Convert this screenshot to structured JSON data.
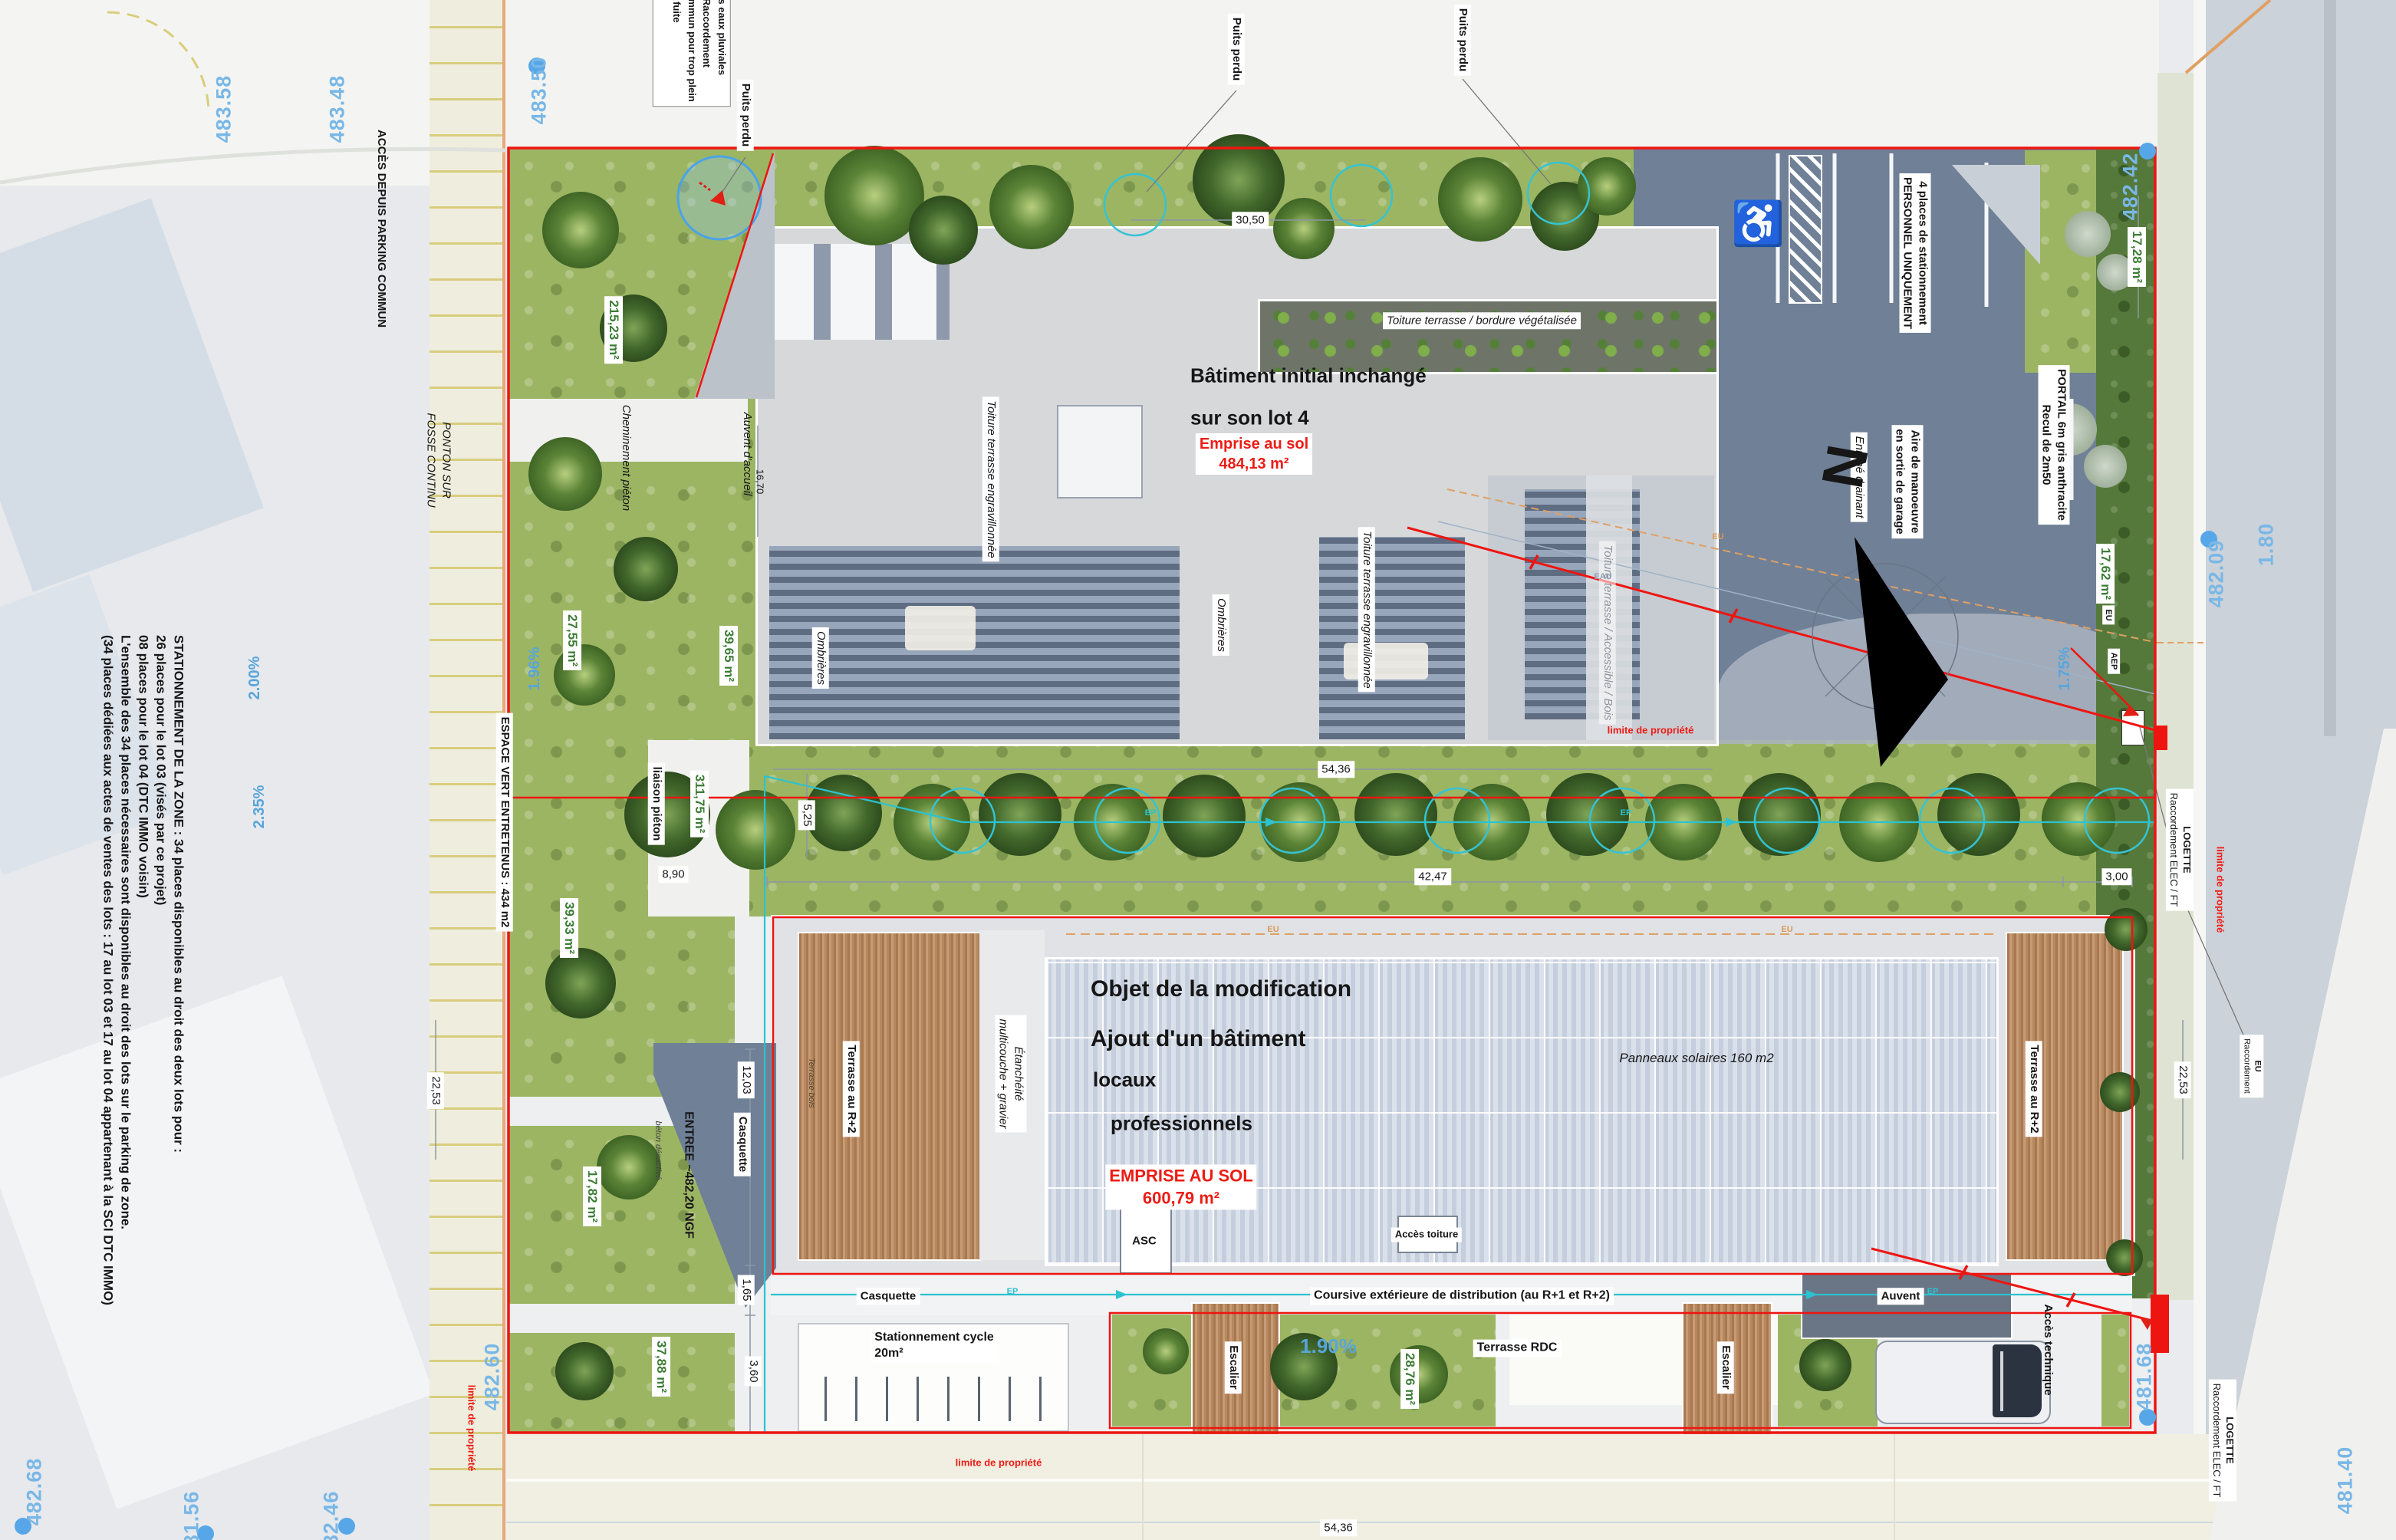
{
  "plan": {
    "notes": {
      "storm_lines": [
        "des eaux pluviales",
        "e. Raccordement",
        "commun pour trop plein",
        "de fuite",
        "re"
      ],
      "parking_lines": [
        "STATIONNEMENT DE LA ZONE : 34 places disponibles au droit des deux lots pour :",
        "26 places pour le lot 03 (visés par ce projet)",
        "08 places pour le lot 04 (DTC IMMO voisin)",
        "L'ensemble des 34 places nécessaires sont disponibles au droit des lots sur le parking de zone.",
        "(34 places dédiées aux actes de ventes des lots : 17 au lot 03 et 17 au lot 04 appartenant à la SCI DTC IMMO)"
      ]
    },
    "roads": {
      "acces_parking": "ACCÈS DEPUIS PARKING COMMUN",
      "ponton_l1": "PONTON SUR",
      "ponton_l2": "FOSSE CONTINU",
      "espace_vert": "ESPACE VERT ENTRETENUS : 434 m2",
      "liaison_pieton": "liaison piéton",
      "cheminement_pieton": "Cheminement piéton"
    },
    "b1": {
      "title_l1": "Bâtiment initial inchangé",
      "title_l2": "sur son lot 4",
      "emprise_l1": "Emprise au sol",
      "emprise_l2": "484,13 m²",
      "toiture_bordure": "Toiture terrasse / bordure végétalisée",
      "toiture_engrav": "Toiture terrasse engravillonnée",
      "toiture_access": "Toiture terrasse / Accessible / Bois",
      "ombrieres": "Ombrières",
      "auvent_accueil": "Auvent d'accueil"
    },
    "b2": {
      "title_l1": "Objet de la modification",
      "title_l2": "Ajout d'un bâtiment",
      "sub_l1": "locaux",
      "sub_l2": "professionnels",
      "emprise_l1": "EMPRISE AU SOL",
      "emprise_l2": "600,79 m²",
      "panneaux": "Panneaux solaires 160 m2",
      "terrasse_r2": "Terrasse au R+2",
      "terrasse_bois": "Terrasse bois",
      "etancheite_l1": "Étanchéité",
      "etancheite_l2": "multicouche + gravier",
      "asc": "ASC",
      "acces_toiture": "Accès toiture",
      "casquette": "Casquette",
      "entree": "ENTREE ~482,20 NGF",
      "beton": "béton désactivé",
      "coursive": "Coursive extérieure de distribution (au R+1 et R+2)",
      "cycle_l1": "Stationnement cycle",
      "cycle_l2": "20m²",
      "escalier": "Escalier",
      "terrasse_rdc": "Terrasse RDC",
      "auvent": "Auvent",
      "acces_technique": "Accès technique"
    },
    "parking": {
      "puits_perdu": "Puits perdu",
      "places_l1": "4 places de stationnement",
      "places_l2": "PERSONNEL UNIQUEMENT",
      "portail_l1": "PORTAIL 6m gris anthracite",
      "portail_l2": "Recul de 2m50",
      "aire_l1": "Aire de manoeuvre",
      "aire_l2": "en sortie de garage",
      "enrobe": "Enrobé drainant",
      "north": "N",
      "handicap_icon": "♿"
    },
    "limits": {
      "limite": "limite de propriété"
    },
    "util": {
      "logette_l1": "LOGETTE",
      "logette_l2": "Raccordement ELEC / FT",
      "eu_racc_l1": "EU",
      "eu_racc_l2": "Raccordement",
      "eu": "EU",
      "aep": "AEP",
      "ep": "EP",
      "eau": "EAU"
    },
    "areas": {
      "a215_23": "215,23 m²",
      "a39_65": "39,65 m²",
      "a27_55": "27,55 m²",
      "a311_75": "311,75 m²",
      "a39_33": "39,33 m²",
      "a17_82": "17,82 m²",
      "a37_88": "37,88 m²",
      "a28_76": "28,76 m²",
      "a17_62": "17,62 m²",
      "a17_28": "17,28 m²"
    },
    "dims": {
      "d30_50": "30,50",
      "d54_36": "54,36",
      "d42_47": "42,47",
      "d3_00": "3,00",
      "d8_90": "8,90",
      "d5_25": "5,25",
      "d12_03": "12,03",
      "d1_65": "1,65",
      "d3_60": "3,60",
      "d16_70": "16,70",
      "d22_53": "22,53"
    },
    "levels": {
      "l483_58": "483.58",
      "l483_48": "483.48",
      "l483_50": "483.50",
      "l482_42": "482.42",
      "l482_09": "482.09",
      "l1_80": "1.80",
      "l482_60": "482.60",
      "l482_68": "482.68",
      "l481_56": "481.56",
      "l482_46": "482.46",
      "l481_68": "481.68",
      "l481_40": "481.40"
    },
    "slopes": {
      "s2_00": "2.00%",
      "s2_35": "2.35%",
      "s1_96": "1.96%",
      "s1_90": "1.90%",
      "s1_75": "1.75%"
    },
    "colors": {
      "property_line": "#ee1511",
      "annotation_cyan": "#2cc2cf",
      "level_blue": "#79b7e6",
      "area_green": "#3c7c35"
    }
  }
}
